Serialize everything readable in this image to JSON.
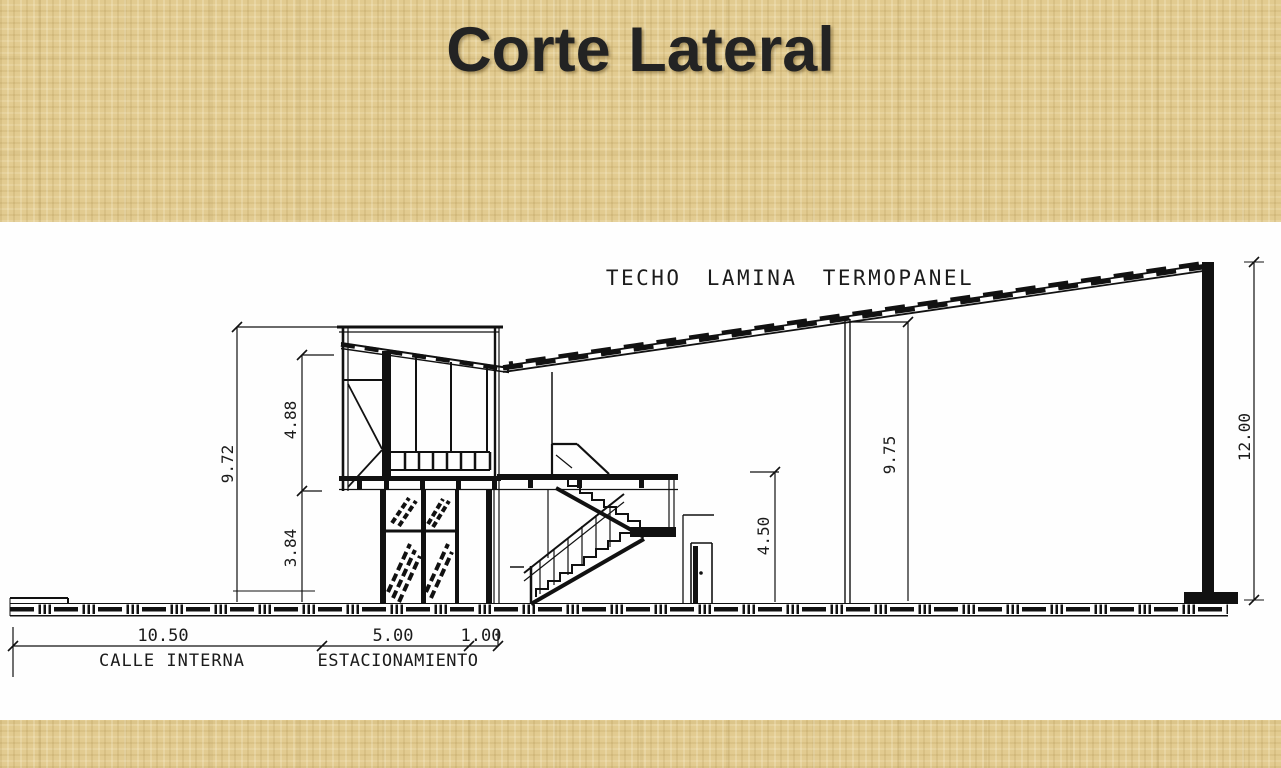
{
  "slide": {
    "title": "Corte Lateral"
  },
  "drawing": {
    "roof_label": "TECHO LAMINA TERMOPANEL",
    "dimensions": {
      "left_total": "9.72",
      "upper_floor": "4.88",
      "lower_floor": "3.84",
      "entry_height": "4.50",
      "interior_height": "9.75",
      "right_total": "12.00",
      "calle_interna_width": "10.50",
      "estacionamiento_width": "5.00",
      "walkway_width": "1.00"
    },
    "ground_labels": {
      "calle": "CALLE INTERNA",
      "estacionamiento": "ESTACIONAMIENTO"
    },
    "colors": {
      "background": "#e2cb90",
      "panel": "#fefefe",
      "line": "#111111",
      "title_text": "#232323"
    }
  }
}
